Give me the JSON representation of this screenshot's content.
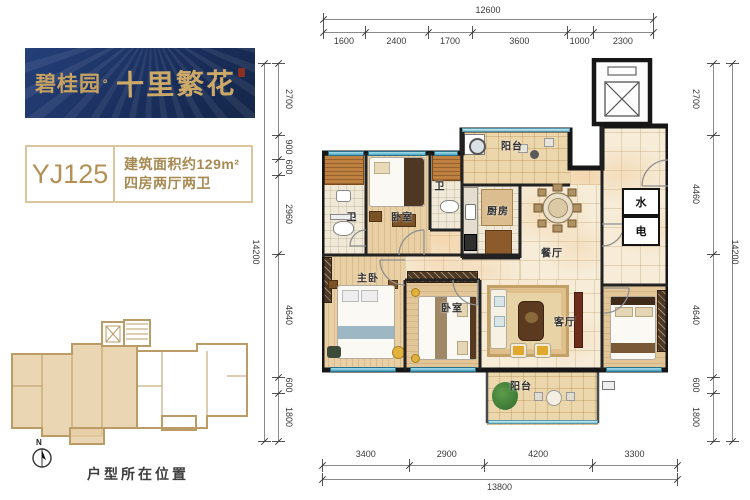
{
  "logo": {
    "brand": "碧桂园",
    "dot": "。",
    "name": "十里繁花"
  },
  "unit": {
    "code": "YJ125",
    "area": "建筑面积约129m²",
    "layout": "四房两厅两卫"
  },
  "key_plan": {
    "caption": "户型所在位置",
    "north_label": "N"
  },
  "plan": {
    "meters": {
      "water": "水",
      "electric": "电"
    },
    "room_labels": [
      {
        "text": "卫",
        "x": 30,
        "y": 158
      },
      {
        "text": "卧室",
        "x": 80,
        "y": 158
      },
      {
        "text": "卫",
        "x": 118,
        "y": 127
      },
      {
        "text": "阳台",
        "x": 190,
        "y": 87
      },
      {
        "text": "厨房",
        "x": 176,
        "y": 152
      },
      {
        "text": "餐厅",
        "x": 230,
        "y": 194
      },
      {
        "text": "主卧",
        "x": 46,
        "y": 219
      },
      {
        "text": "卧室",
        "x": 130,
        "y": 249
      },
      {
        "text": "客厅",
        "x": 243,
        "y": 263
      },
      {
        "text": "阳台",
        "x": 199,
        "y": 327
      }
    ]
  },
  "dimensions": {
    "top": {
      "total": 12600,
      "segments": [
        1600,
        2400,
        1700,
        3600,
        1000,
        2300
      ]
    },
    "bottom": {
      "total": 13800,
      "segments": [
        3400,
        2900,
        4200,
        3300
      ]
    },
    "left": {
      "total": 14200,
      "segments": [
        2700,
        900,
        600,
        2960,
        4640,
        600,
        1800
      ]
    },
    "right": {
      "total": 14200,
      "segments": [
        2700,
        4460,
        4640,
        600,
        1800
      ]
    }
  },
  "colors": {
    "brand_navy": "#1c3263",
    "brand_gold": "#c7a261",
    "info_tan": "#a68a52",
    "keyplan_outline": "#bb9c66",
    "keyplan_fill": "#e6cfa4",
    "window_teal": "#4da5c0",
    "wall_black": "#161616"
  }
}
